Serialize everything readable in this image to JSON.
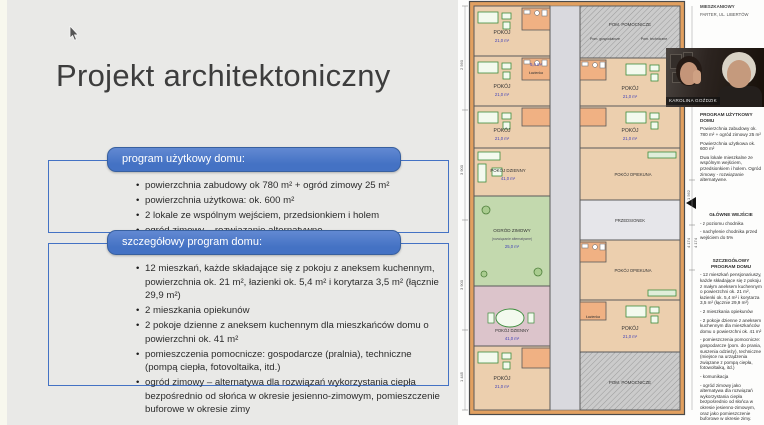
{
  "slide": {
    "title": "Projekt architektoniczny",
    "program_box": {
      "header": "program użytkowy domu:",
      "bullets": [
        "powierzchnia zabudowy ok 780 m² + ogród zimowy 25 m²",
        "powierzchnia użytkowa: ok. 600 m²",
        "2 lokale ze wspólnym wejściem, przedsionkiem i holem",
        "ogród zimowy – rozwiązanie alternatywne"
      ]
    },
    "detail_box": {
      "header": "szczegółowy program domu:",
      "bullets": [
        "12 mieszkań, każde składające się z pokoju z aneksem kuchennym, powierzchnia ok. 21 m², łazienki ok. 5,4 m² i korytarza 3,5 m² (łącznie 29,9 m²)",
        "2 mieszkania opiekunów",
        "2 pokoje dzienne z aneksem kuchennym dla mieszkańców domu o powierzchni ok. 41 m²",
        "pomieszczenia pomocnicze: gospodarcze (pralnia), techniczne (pompą ciepła, fotovoltaika, itd.)",
        "ogród zimowy – alternatywa dla rozwiązań wykorzystania ciepła bezpośrednio od słońca w okresie jesienno-zimowym, pomieszczenie buforowe w okresie zimy"
      ]
    }
  },
  "plan": {
    "title_line1": "MIESZKANIOWY",
    "title_line2": "PARTER, UL. LIBERTÓW",
    "room_pokoj": "POKÓJ",
    "room_pokoj_dzienny": "POKÓJ DZIENNY",
    "room_ogrod": "OGRÓD ZIMOWY",
    "room_ogrod_sub": "(rozwiązanie alternatywne)",
    "room_opiekun": "POKÓJ OPIEKUNA",
    "room_przedsionek": "PRZEDSIONEK",
    "room_pomocnicze": "POM. POMOCNICZE",
    "room_gospodarcze": "Pom. gospodarcze",
    "room_techniczne": "Pom. techniczne",
    "room_lazienka": "Łazienka",
    "area_pokoj": "21,0 m²",
    "area_dzienny": "41,0 m²",
    "area_ogrod": "25,0 m²",
    "area_lazienka": "5,4 m²",
    "dims_left": [
      "2 560",
      "3 900",
      "3 900",
      "1 445"
    ],
    "dims_right": [
      "1 562",
      "4 174",
      "4 174"
    ]
  },
  "sidebar": {
    "heading1": "PROGRAM UŻYTKOWY DOMU",
    "para1": "Powierzchnia zabudowy ok. 780 m² + ogród zimowy 25 m²",
    "para2": "Powierzchnia użytkowa ok. 600 m²",
    "para3": "Dwa lokale mieszkalne ze wspólnym wejściem, przedsionkiem i holem. Ogród zimowy - rozwiązanie alternatywne.",
    "heading2": "GŁÓWNE WEJŚCIE",
    "entry_items": [
      "- z poziomu chodnika",
      "- nachylenie chodnika przed wejściem do 5%"
    ],
    "heading3": "SZCZEGÓŁOWY PROGRAM DOMU",
    "detail_items": [
      "- 12 mieszkań pensjonariuszy, każde składające się z pokoju z małym aneksem kuchennym o powierzchni ok. 21 m², łazienki ok. 5,4 m² i korytarza 3,5 m² (łącznie 29,9 m²)",
      "- 2 mieszkania opiekunów",
      "- 2 pokoje dzienne z aneksem kuchennym dla mieszkańców domu o powierzchni ok. 41 m²",
      "- pomieszczenia pomocnicze: gospodarcze (pom. do prania, suszenia odzieży), techniczne (miejsce na urządzenia związane z pompą ciepła, fotowoltaiką, itd.)",
      "- komunikacja",
      "- ogród zimowy jako alternatywa dla rozwiązań wykorzystania ciepła bezpośrednio od słońca w okresie jesienno-zimowym, oraz jako pomieszczenie buforowe w okresie zimy."
    ]
  },
  "webcam": {
    "name_label": "KAROLINA GOŹDZIK"
  },
  "colors": {
    "accent_blue": "#4472c4",
    "room_beige": "#eccfae",
    "bath_salmon": "#f0b183",
    "garden_green": "#c3d9ae",
    "dining_pink": "#dcc4cb",
    "corridor_gray": "#d9d9de",
    "utility_gray": "#c9c9c9"
  }
}
